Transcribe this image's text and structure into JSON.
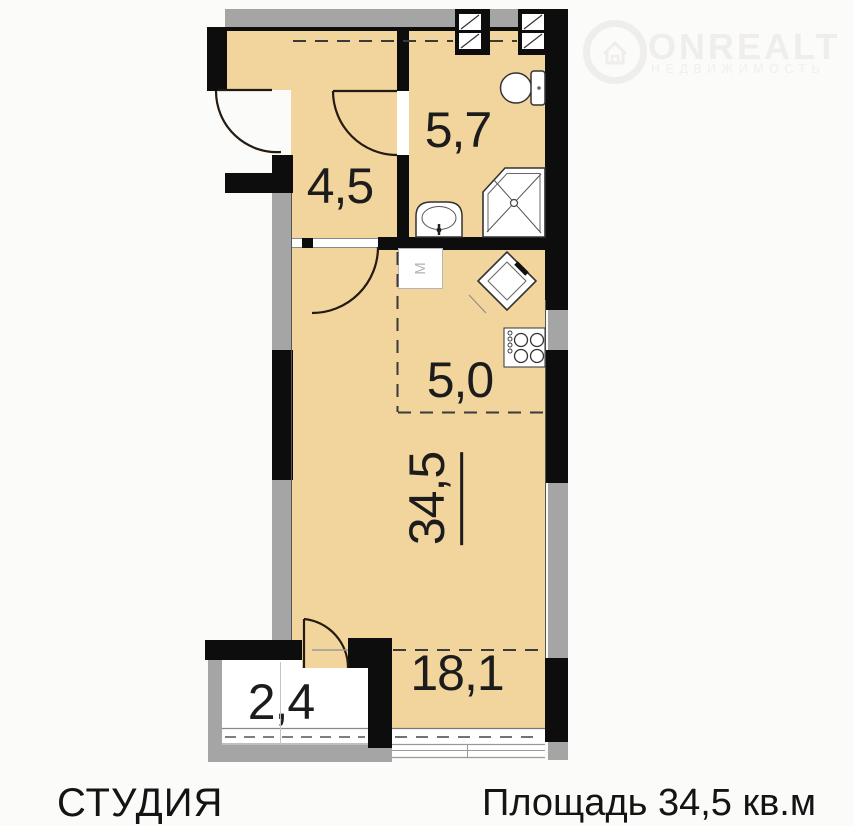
{
  "plan": {
    "rooms": {
      "bathroom": {
        "area": "5,7"
      },
      "hallway": {
        "area": "4,5"
      },
      "kitchen_zone": {
        "area": "5,0"
      },
      "studio_total": {
        "area": "34,5"
      },
      "living_zone": {
        "area": "18,1"
      },
      "balcony": {
        "area": "2,4"
      }
    },
    "washing_machine_label": "M",
    "icons": [
      "toilet-icon",
      "bathroom-sink-icon",
      "shower-cabin-icon",
      "washing-machine-icon",
      "kitchen-sink-icon",
      "cooktop-icon",
      "vent-grille-icon",
      "door-swing-arc"
    ]
  },
  "logo": {
    "brand": "ONREALT",
    "subtitle": "НЕДВИЖИМОСТЬ",
    "icon": "house-logo-icon",
    "color": "#efeeec"
  },
  "footer": {
    "apartment_type": "СТУДИЯ",
    "total_area": "Площадь 34,5 кв.м"
  },
  "colors": {
    "floor": "#f2d49d",
    "wall": "#0d0d0d",
    "outer_wall": "#a5a5a5",
    "label": "#1c1c1c",
    "background": "#fbfbfa"
  }
}
